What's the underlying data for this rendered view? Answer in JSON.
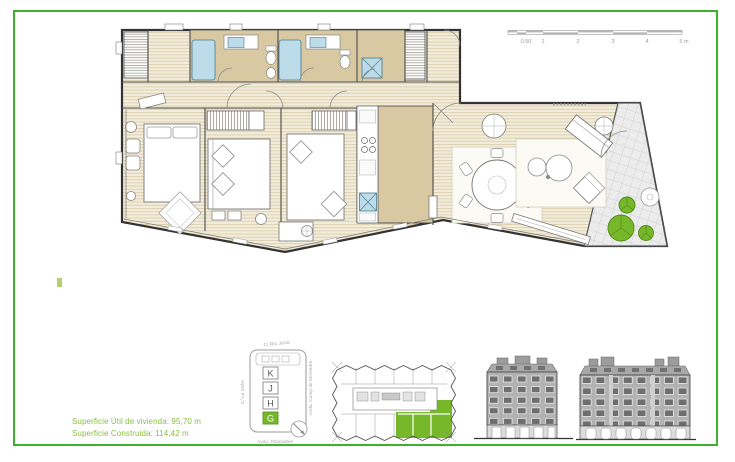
{
  "colors": {
    "frame_green": "#3faf2e",
    "area_text_green": "#8cbf3f",
    "unit_highlight_green": "#76b82a",
    "bathroom_floor_tan": "#d9c9a2",
    "fixture_blue": "#bcdce9",
    "tree_green": "#76b82a"
  },
  "areas": {
    "useful": "Superficie Útil de vivienda: 95,70 m",
    "built": "Superficie Construida: 114,42 m"
  },
  "floor_plan": {
    "scale_bar": {
      "ticks": [
        "0.50",
        "1",
        "2",
        "3",
        "4",
        "5 m"
      ]
    }
  },
  "key_plan": {
    "street_top": "C/ Río Júcar",
    "street_left": "C/ La Safor",
    "street_right": "Avda. Camp de Morvedre",
    "street_bottom": "Avda. Ribesaltes",
    "units": [
      "K",
      "J",
      "H",
      "G"
    ],
    "highlighted_unit": "G"
  },
  "icons": {
    "north_compass": "circle-with-diagonal-arrow",
    "tree": "green-canopy-circle"
  }
}
